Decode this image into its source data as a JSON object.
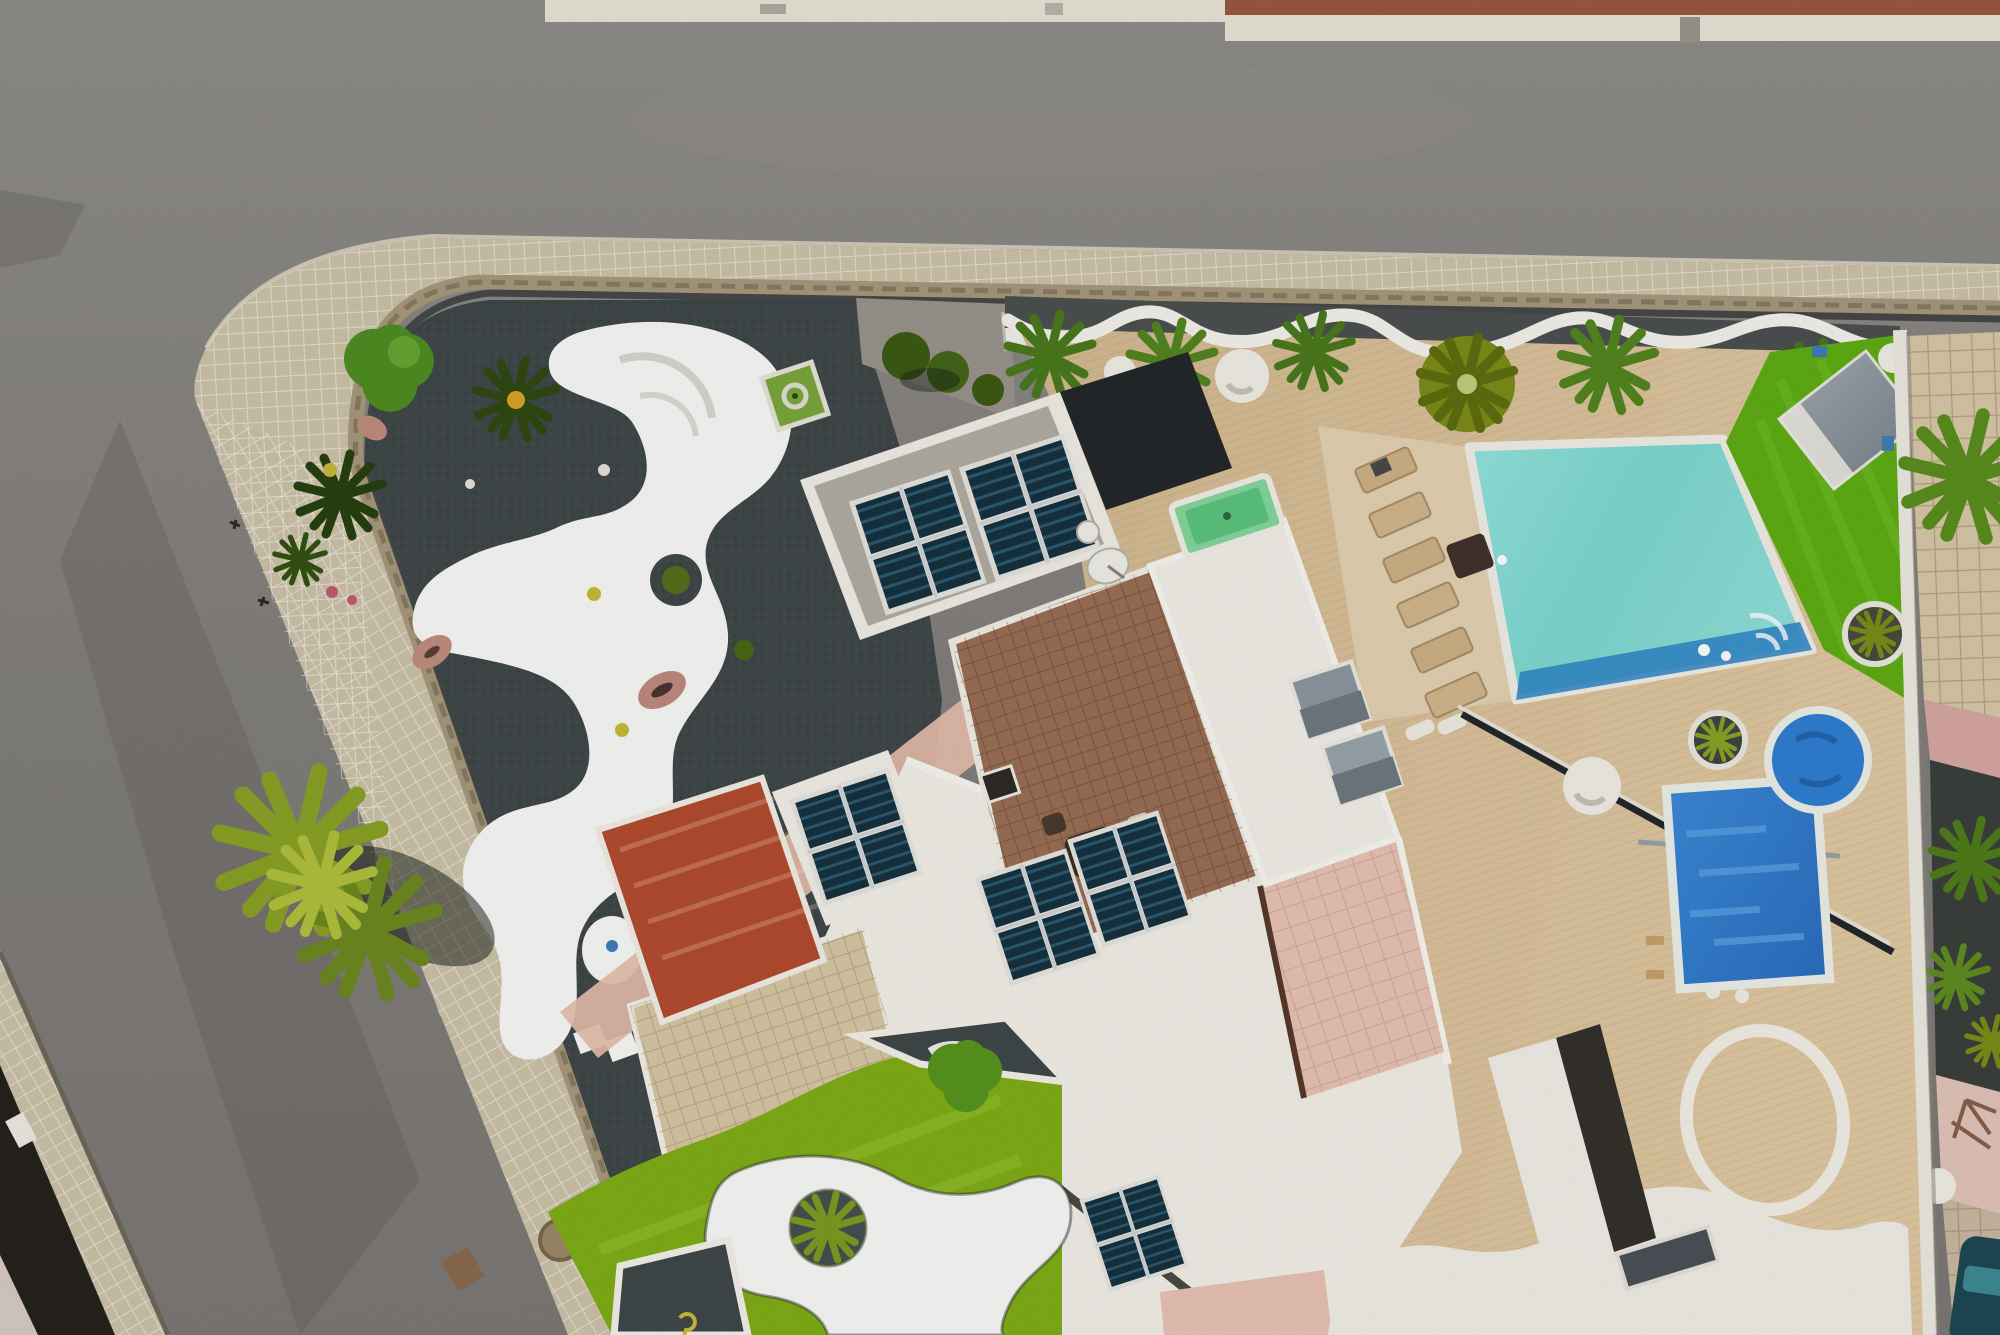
{
  "scene": {
    "type": "aerial-drone-photo",
    "camera": "top-down",
    "subject": "Corner villa plot with black lava-gravel garden, white painted organic paths, rooftop solar panels, swimming pool, artificial lawn and mini-golf turf, bordered by two asphalt streets",
    "elements": [
      "asphalt road (top)",
      "asphalt road (left, diagonal)",
      "tiled sidewalk with rounded corner",
      "street lamp",
      "lava gravel garden",
      "white painted amoeba paths",
      "round tree",
      "spiky palms and yucca",
      "pink oval stones",
      "entrance driveway",
      "white gate box",
      "villa rooftop terrace with solar arrays",
      "satellite dishes",
      "outdoor pool table",
      "brown tiled roof with furniture",
      "orange-red roof deck with solar array",
      "white flat roofs with solar arrays",
      "beige wood-look terrace with wavy white border",
      "white sphere planters",
      "swimming pool with sun loungers",
      "artificial lawn with shed",
      "blue covered pool",
      "blue covered spa",
      "wooden deck with white painted ring",
      "mini-golf turf with white shapes and agave island",
      "checkered patio",
      "neighbor plot with tiled patio and pink terrace",
      "parked car",
      "big palm cluster"
    ],
    "counts": {
      "solar_panel_arrays": 6,
      "sun_loungers": 6,
      "satellite_dishes": 2,
      "white_planters": 3
    }
  },
  "palette": {
    "road": "#85827e",
    "road_dark": "#6f6c68",
    "road_light": "#9b968e",
    "sidewalk": "#cdc4a9",
    "curb": "#a89a7c",
    "wall_dark": "#3a3d3f",
    "gravel": "#414849",
    "gravel_strip": "#4c5150",
    "white_paint": "#fafaf8",
    "terrace": "#dcc29b",
    "terrace_light": "#e6d6b6",
    "pool": "#7fd9d2",
    "pool_deep": "#2e86c8",
    "grass": "#5fae14",
    "turf": "#7fae17",
    "solar": "#16323f",
    "solar_stripe": "#2c5a70",
    "panel_frame": "#e8e6df",
    "roof_brown": "#9b6f56",
    "roof_orange": "#b44c2f",
    "roof_white": "#f4f1ea",
    "salmon": "#e9c4b4",
    "checker": "#d8c8a6",
    "table_green": "#86d89e",
    "blue_cover": "#2f7fd4",
    "shed": "#8f9aa3",
    "palm": "#4a7a1c",
    "palm_yellow": "#9fb32c",
    "tree": "#4e8f23",
    "olive": "#7d8d18",
    "stone": "#c28e80",
    "neighbor_tile": "#d9c9a9",
    "neighbor_pink": "#e4c6ba",
    "neighbor_gravel": "#3c403d",
    "car": "#1f4954",
    "fence": "#24282a",
    "top_roof": "#9a5a40",
    "cream": "#e9e5d8",
    "lamp": "#1c1e20",
    "yellow_dot": "#c8bb3a"
  }
}
